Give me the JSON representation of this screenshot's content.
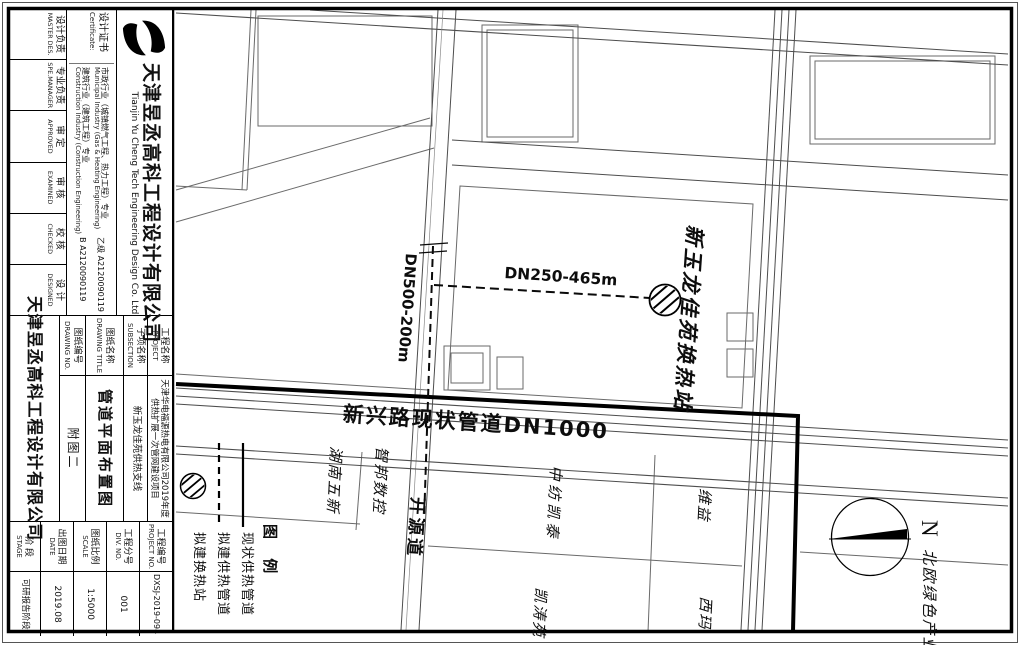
{
  "colors": {
    "line": "#000000",
    "paper": "#ffffff"
  },
  "title_block": {
    "company_cn": "天津昱丞高科工程设计有限公司",
    "company_en": "Tianjin Yu Cheng Tech Engineering Design Co. Ltd",
    "cert_label_cn": "设计证书",
    "cert_label_en": "Certificate:",
    "certs": [
      {
        "cn": "市政行业（城镇燃气工程、热力工程）专业",
        "en": "Municipal Industry (Gas & Heating Engineering)",
        "no": "乙级 A2120090119"
      },
      {
        "cn": "建筑行业（建筑工程）专业",
        "en": "Construction Industry (Construction Engineering)",
        "no": "B A2120090119"
      }
    ],
    "roles": [
      {
        "cn": "设计负责",
        "en": "MASTER DES."
      },
      {
        "cn": "专业负责",
        "en": "SPE.MANAGER"
      },
      {
        "cn": "审 定",
        "en": "APPROVED"
      },
      {
        "cn": "审 核",
        "en": "EXAMINED"
      },
      {
        "cn": "校 核",
        "en": "CHECKED"
      },
      {
        "cn": "设 计",
        "en": "DESIGNED"
      }
    ],
    "rows": [
      {
        "cn": "工程名称",
        "en": "PROJECT",
        "value": "天津华电福源热电有限公司2019年度供热扩展一次管网建设项目"
      },
      {
        "cn": "子项名称",
        "en": "SUBSECTION",
        "value": "新玉龙佳苑供热支线"
      },
      {
        "cn": "图纸名称",
        "en": "DRAWING TITLE",
        "value": "管道平面布置图"
      },
      {
        "cn": "图纸编号",
        "en": "DRAWING NO.",
        "value": "附图二"
      }
    ],
    "company_footer": "天津昱丞高科工程设计有限公司",
    "meta": [
      {
        "cn": "工程编号",
        "en": "PROJECT NO.",
        "value": "DXSJ-2019-094"
      },
      {
        "cn": "工程分号",
        "en": "DIV. NO.",
        "value": "001"
      },
      {
        "cn": "图纸比例",
        "en": "SCALE",
        "value": "1:5000"
      },
      {
        "cn": "出图日期",
        "en": "DATE",
        "value": "2019.08"
      },
      {
        "cn": "阶 段",
        "en": "STAGE",
        "value": "可研报告阶段"
      }
    ]
  },
  "map": {
    "pipe_existing_label": "新兴路现状管道DN1000",
    "pipe_branch_label": "DN250-465m",
    "pipe_new_label": "DN500-200m",
    "station_label": "新玉龙佳苑换热站",
    "road_label": "开源道",
    "areas": [
      "湖南五新",
      "智邦数控",
      "中纺凯泰",
      "凯涛苑",
      "维益",
      "西玛",
      "北欧绿色产业园"
    ],
    "north_label": "N",
    "legend": {
      "title": "图 例",
      "items": [
        {
          "label": "现状供热管道",
          "symbol": "solid-line"
        },
        {
          "label": "拟建供热管道",
          "symbol": "dashed-line"
        },
        {
          "label": "拟建换热站",
          "symbol": "hatched-circle"
        }
      ]
    }
  }
}
